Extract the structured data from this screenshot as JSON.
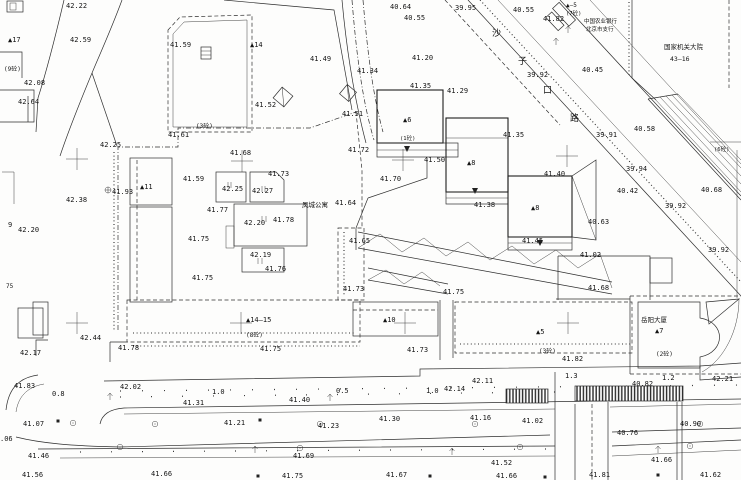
{
  "drawing": {
    "kind": "cadastral site plan",
    "ink_color": "#2e2e2e",
    "paper_color": "#fdfdfc"
  },
  "street_name_chars": [
    {
      "t": "沙",
      "x": 492,
      "y": 36,
      "fs": 9
    },
    {
      "t": "子",
      "x": 518,
      "y": 64,
      "fs": 9
    },
    {
      "t": "口",
      "x": 543,
      "y": 93,
      "fs": 9
    },
    {
      "t": "路",
      "x": 570,
      "y": 121,
      "fs": 9
    }
  ],
  "place_names": [
    {
      "t": "凤城公寓",
      "x": 302,
      "y": 207,
      "fs": 6.5
    },
    {
      "t": "中国农业银行",
      "x": 584,
      "y": 23,
      "fs": 5.5
    },
    {
      "t": "北京市支行",
      "x": 586,
      "y": 31,
      "fs": 5.5
    },
    {
      "t": "国家机关大院",
      "x": 664,
      "y": 49,
      "fs": 6.5
    },
    {
      "t": "43—16",
      "x": 670,
      "y": 61,
      "fs": 6.5
    },
    {
      "t": "岳阳大厦",
      "x": 641,
      "y": 322,
      "fs": 6.5
    }
  ],
  "building_numbers": [
    {
      "t": "▲17",
      "x": 8,
      "y": 42,
      "fs": 7
    },
    {
      "t": "▲14",
      "x": 250,
      "y": 47,
      "fs": 7
    },
    {
      "t": "▲11",
      "x": 140,
      "y": 189,
      "fs": 7
    },
    {
      "t": "▲6",
      "x": 403,
      "y": 122,
      "fs": 7
    },
    {
      "t": "▲8",
      "x": 467,
      "y": 165,
      "fs": 7
    },
    {
      "t": "▲8",
      "x": 531,
      "y": 210,
      "fs": 7
    },
    {
      "t": "▲14—15",
      "x": 246,
      "y": 322,
      "fs": 7
    },
    {
      "t": "▲10",
      "x": 383,
      "y": 322,
      "fs": 7
    },
    {
      "t": "▲5",
      "x": 536,
      "y": 334,
      "fs": 7
    },
    {
      "t": "▲7",
      "x": 655,
      "y": 333,
      "fs": 7
    },
    {
      "t": "▲—5",
      "x": 566,
      "y": 7,
      "fs": 6
    },
    {
      "t": "(9砼)",
      "x": 4,
      "y": 71,
      "fs": 6
    },
    {
      "t": "(3砼)",
      "x": 196,
      "y": 128,
      "fs": 6
    },
    {
      "t": "(7砼)",
      "x": 566,
      "y": 15,
      "fs": 5.5
    },
    {
      "t": "(1砼)",
      "x": 400,
      "y": 140,
      "fs": 5.5
    },
    {
      "t": "(6砼)",
      "x": 714,
      "y": 151,
      "fs": 5.5
    },
    {
      "t": "(8砼)",
      "x": 246,
      "y": 337,
      "fs": 6
    },
    {
      "t": "(3砼)",
      "x": 539,
      "y": 353,
      "fs": 6
    },
    {
      "t": "(2砼)",
      "x": 656,
      "y": 356,
      "fs": 6
    }
  ],
  "elevations": [
    {
      "t": "42.22",
      "x": 66,
      "y": 8
    },
    {
      "t": "42.59",
      "x": 70,
      "y": 42
    },
    {
      "t": "41.59",
      "x": 170,
      "y": 47
    },
    {
      "t": "42.08",
      "x": 24,
      "y": 85
    },
    {
      "t": "42.64",
      "x": 18,
      "y": 104
    },
    {
      "t": "41.52",
      "x": 255,
      "y": 107
    },
    {
      "t": "41.49",
      "x": 310,
      "y": 61
    },
    {
      "t": "41.34",
      "x": 357,
      "y": 73
    },
    {
      "t": "40.64",
      "x": 390,
      "y": 9
    },
    {
      "t": "40.55",
      "x": 404,
      "y": 20
    },
    {
      "t": "39.95",
      "x": 455,
      "y": 10
    },
    {
      "t": "40.55",
      "x": 513,
      "y": 12
    },
    {
      "t": "41.82",
      "x": 543,
      "y": 21
    },
    {
      "t": "41.20",
      "x": 412,
      "y": 60
    },
    {
      "t": "41.35",
      "x": 410,
      "y": 88
    },
    {
      "t": "41.29",
      "x": 447,
      "y": 93
    },
    {
      "t": "39.92",
      "x": 527,
      "y": 77
    },
    {
      "t": "40.45",
      "x": 582,
      "y": 72
    },
    {
      "t": "41.35",
      "x": 503,
      "y": 137
    },
    {
      "t": "39.91",
      "x": 596,
      "y": 137
    },
    {
      "t": "40.58",
      "x": 634,
      "y": 131
    },
    {
      "t": "41.51",
      "x": 342,
      "y": 116
    },
    {
      "t": "41.61",
      "x": 168,
      "y": 137
    },
    {
      "t": "42.25",
      "x": 100,
      "y": 147
    },
    {
      "t": "41.68",
      "x": 230,
      "y": 155
    },
    {
      "t": "41.72",
      "x": 348,
      "y": 152
    },
    {
      "t": "42.38",
      "x": 66,
      "y": 202
    },
    {
      "t": "41.93",
      "x": 112,
      "y": 194
    },
    {
      "t": "41.59",
      "x": 183,
      "y": 181
    },
    {
      "t": "41.73",
      "x": 268,
      "y": 176
    },
    {
      "t": "42.25",
      "x": 222,
      "y": 191
    },
    {
      "t": "42.27",
      "x": 252,
      "y": 193
    },
    {
      "t": "41.77",
      "x": 207,
      "y": 212
    },
    {
      "t": "42.20",
      "x": 244,
      "y": 225
    },
    {
      "t": "41.78",
      "x": 273,
      "y": 222
    },
    {
      "t": "41.75",
      "x": 188,
      "y": 241
    },
    {
      "t": "42.19",
      "x": 250,
      "y": 257
    },
    {
      "t": "41.76",
      "x": 265,
      "y": 271
    },
    {
      "t": "41.75",
      "x": 192,
      "y": 280
    },
    {
      "t": "41.64",
      "x": 335,
      "y": 205
    },
    {
      "t": "41.70",
      "x": 380,
      "y": 181
    },
    {
      "t": "41.50",
      "x": 424,
      "y": 162
    },
    {
      "t": "41.40",
      "x": 544,
      "y": 176
    },
    {
      "t": "41.38",
      "x": 474,
      "y": 207
    },
    {
      "t": "41.45",
      "x": 522,
      "y": 243
    },
    {
      "t": "41.65",
      "x": 349,
      "y": 243
    },
    {
      "t": "40.63",
      "x": 588,
      "y": 224
    },
    {
      "t": "41.02",
      "x": 580,
      "y": 257
    },
    {
      "t": "39.92",
      "x": 665,
      "y": 208
    },
    {
      "t": "40.42",
      "x": 617,
      "y": 193
    },
    {
      "t": "39.94",
      "x": 626,
      "y": 171
    },
    {
      "t": "40.68",
      "x": 701,
      "y": 192
    },
    {
      "t": "39.92",
      "x": 708,
      "y": 252
    },
    {
      "t": "41.68",
      "x": 588,
      "y": 290
    },
    {
      "t": "41.73",
      "x": 343,
      "y": 291
    },
    {
      "t": "41.75",
      "x": 443,
      "y": 294
    },
    {
      "t": "42.44",
      "x": 80,
      "y": 340
    },
    {
      "t": "42.17",
      "x": 20,
      "y": 355
    },
    {
      "t": "41.78",
      "x": 118,
      "y": 350
    },
    {
      "t": "41.75",
      "x": 260,
      "y": 351
    },
    {
      "t": "41.73",
      "x": 407,
      "y": 352
    },
    {
      "t": "41.82",
      "x": 562,
      "y": 361
    },
    {
      "t": "42.21",
      "x": 712,
      "y": 381
    },
    {
      "t": "41.83",
      "x": 14,
      "y": 388
    },
    {
      "t": "42.02",
      "x": 120,
      "y": 389
    },
    {
      "t": "41.31",
      "x": 183,
      "y": 405
    },
    {
      "t": "41.40",
      "x": 289,
      "y": 402
    },
    {
      "t": "42.14",
      "x": 444,
      "y": 391
    },
    {
      "t": "42.11",
      "x": 472,
      "y": 383
    },
    {
      "t": "41.30",
      "x": 379,
      "y": 421
    },
    {
      "t": "41.16",
      "x": 470,
      "y": 420
    },
    {
      "t": "40.82",
      "x": 632,
      "y": 386
    },
    {
      "t": "41.07",
      "x": 23,
      "y": 426
    },
    {
      "t": ".06",
      "x": 0,
      "y": 441
    },
    {
      "t": "41.21",
      "x": 224,
      "y": 425
    },
    {
      "t": "41.23",
      "x": 318,
      "y": 428
    },
    {
      "t": "41.02",
      "x": 522,
      "y": 423
    },
    {
      "t": "40.90",
      "x": 680,
      "y": 426
    },
    {
      "t": "40.76",
      "x": 617,
      "y": 435
    },
    {
      "t": "41.46",
      "x": 28,
      "y": 458
    },
    {
      "t": "41.69",
      "x": 293,
      "y": 458
    },
    {
      "t": "41.52",
      "x": 491,
      "y": 465
    },
    {
      "t": "41.66",
      "x": 651,
      "y": 462
    },
    {
      "t": "41.56",
      "x": 22,
      "y": 477
    },
    {
      "t": "41.66",
      "x": 151,
      "y": 476
    },
    {
      "t": "41.75",
      "x": 282,
      "y": 478
    },
    {
      "t": "41.67",
      "x": 386,
      "y": 477
    },
    {
      "t": "41.66",
      "x": 496,
      "y": 478
    },
    {
      "t": "41.81",
      "x": 589,
      "y": 477
    },
    {
      "t": "41.62",
      "x": 700,
      "y": 477
    },
    {
      "t": "9",
      "x": 8,
      "y": 227
    },
    {
      "t": "42.20",
      "x": 18,
      "y": 232
    },
    {
      "t": "75",
      "x": 6,
      "y": 288,
      "fs": 6
    }
  ],
  "dimensions": [
    {
      "t": "0.8",
      "x": 52,
      "y": 396
    },
    {
      "t": "1.0",
      "x": 212,
      "y": 394
    },
    {
      "t": "0.5",
      "x": 336,
      "y": 393
    },
    {
      "t": "1.0",
      "x": 426,
      "y": 393
    },
    {
      "t": "1.3",
      "x": 565,
      "y": 378
    },
    {
      "t": "1.2",
      "x": 662,
      "y": 380
    }
  ],
  "symbols": {
    "grid_crosses": [
      [
        77,
        159
      ],
      [
        242,
        161
      ],
      [
        403,
        160
      ],
      [
        567,
        156
      ],
      [
        77,
        323
      ],
      [
        241,
        323
      ],
      [
        405,
        323
      ],
      [
        568,
        323
      ]
    ],
    "trees": [
      [
        73,
        423
      ],
      [
        155,
        424
      ],
      [
        320,
        424
      ],
      [
        475,
        424
      ],
      [
        700,
        424
      ],
      [
        120,
        447
      ],
      [
        300,
        448
      ],
      [
        520,
        447
      ],
      [
        690,
        446
      ]
    ],
    "lamps": [
      [
        110,
        400
      ],
      [
        330,
        401
      ],
      [
        255,
        453
      ],
      [
        452,
        455
      ],
      [
        658,
        453
      ],
      [
        568,
        33
      ],
      [
        556,
        45
      ]
    ],
    "squares": [
      [
        58,
        421
      ],
      [
        260,
        420
      ],
      [
        258,
        476
      ],
      [
        430,
        476
      ],
      [
        545,
        477
      ],
      [
        658,
        475
      ]
    ],
    "benchmarks": [
      [
        108,
        190
      ]
    ]
  }
}
